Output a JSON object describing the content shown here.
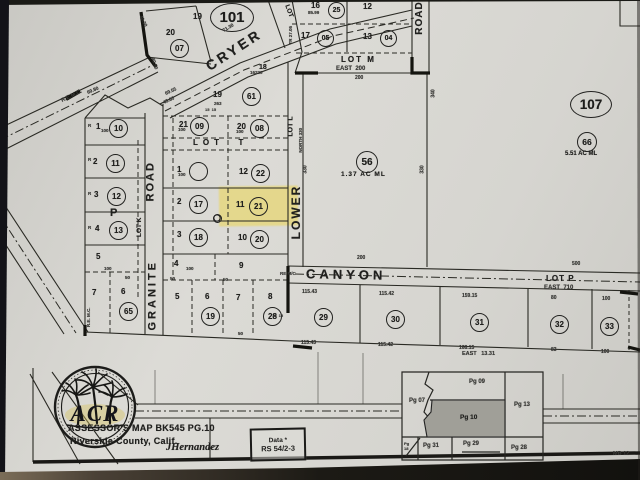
{
  "footer": {
    "title1": "ASSESSOR'S MAP BK545 PG.10",
    "title2": "Riverside County, Calif.",
    "signature": "JHernandez",
    "box1": "Data *",
    "box2": "RS 54/2-3",
    "logo": "ACR"
  },
  "roads": {
    "cryer": "CRYER",
    "canyon": "CANYON",
    "granite": "GRANITE",
    "granite_road": "ROAD",
    "lower": "LOWER",
    "road_top": "ROAD"
  },
  "lots": {
    "t": "LOT  T",
    "m": "LOT M",
    "p": "LOT P",
    "k": "LOT K",
    "l": "LOT L",
    "diag": "LOT",
    "north330": "NORTH 330",
    "east200": "EAST  200",
    "east710": "EAST  710",
    "east1331": "EAST   13.31",
    "remc_a": "R.E.M.C.",
    "remc_b": "R.E. M.C.",
    "remc_c": "RE M/C",
    "pblock": "P"
  },
  "circles": {
    "k07": "07",
    "k101": "101",
    "k25": "25",
    "k05": "05",
    "k04": "04",
    "k61": "61",
    "k09": "09",
    "k08": "08",
    "k10": "10",
    "k11": "11",
    "k12": "12",
    "k13": "13",
    "k16": "16",
    "k22": "22",
    "k17": "17",
    "k21": "21",
    "k18": "18",
    "k20": "20",
    "k65": "65",
    "k19": "19",
    "k28": "28",
    "k29": "29",
    "k30": "30",
    "k31": "31",
    "k32": "32",
    "k33": "33",
    "k56": "56",
    "k66": "66",
    "k107": "107"
  },
  "nums": {
    "t19": "19",
    "t20": "20",
    "t16": "16",
    "t12": "12",
    "t17": "17",
    "t13": "13",
    "c18": "18",
    "s19": "19",
    "m21": "21",
    "r20": "20",
    "l1": "1",
    "l2": "2",
    "l3": "3",
    "l4": "4",
    "l5": "5",
    "l6": "6",
    "l7": "7",
    "a1": "1",
    "a2": "2",
    "a3": "3",
    "a4": "4",
    "a5": "5",
    "a6": "6",
    "a7": "7",
    "a8": "8",
    "a9": "9",
    "b10": "10",
    "b11": "11",
    "b12": "12",
    "rr": "R"
  },
  "areas": {
    "a56": "1.37 AC ML",
    "a66": "5.51 AC ML"
  },
  "dims": {
    "d4030": "40.30",
    "d4050": "40.50",
    "d7130": "71.30",
    "d6955": "69.55",
    "d4380": "43.80",
    "d6980": "69.80",
    "d8599": "85.99",
    "dtr": "TR 27.05",
    "d16220": "16220",
    "d263": "263",
    "d100": "100",
    "d50": "50",
    "d200": "200",
    "d1515": "15  15",
    "d330": "330",
    "d340": "340",
    "d500": "500",
    "dt1": "115.43",
    "dt2": "115.42",
    "dt3": "159.15",
    "dt4": "80",
    "db3": "168.15",
    "db4": "83"
  },
  "inset": {
    "pg07": "Pg 07",
    "pg09": "Pg 09",
    "pg10": "Pg 10",
    "pg13": "Pg 13",
    "pg18": "Pg 18",
    "pg28": "Pg 28",
    "pg29": "Pg 29",
    "pg31": "Pg 31",
    "mb": "MB 12"
  }
}
